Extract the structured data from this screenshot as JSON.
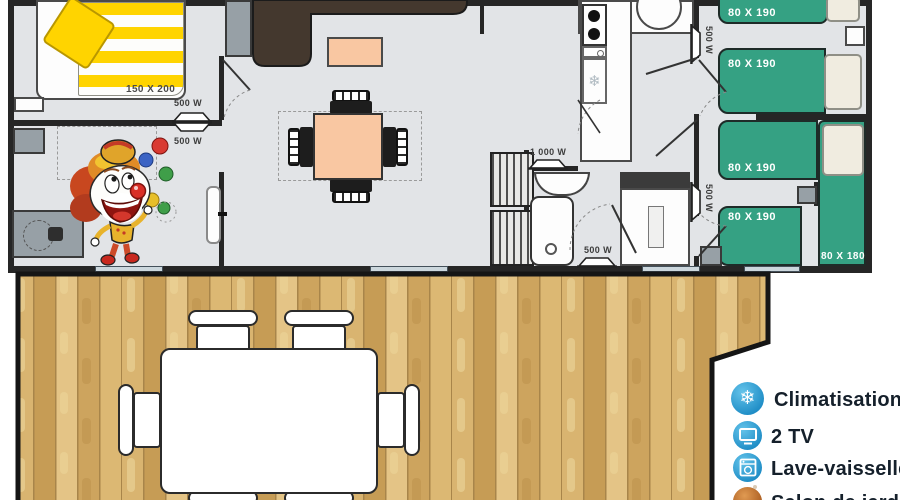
{
  "plan": {
    "master_bedroom": {
      "bed_label": "150 X 200"
    },
    "bedroom1": {
      "bed1_label": "80 X 190",
      "bed2_label": "80 X 190"
    },
    "bedroom2": {
      "bed3_label": "80 X 190",
      "bed4_label": "80 X 190",
      "corner_bed_label": "80 X 180"
    },
    "heaters": {
      "living_top": "500 W",
      "living_bottom": "500 W",
      "hall_upper": "500 W",
      "hall_lower": "500 W",
      "bathroom": "1 000 W",
      "shower_room": "500 W"
    }
  },
  "legend": {
    "items": [
      {
        "icon": "snowflake",
        "label": "Climatisation"
      },
      {
        "icon": "tv",
        "label": "2 TV"
      },
      {
        "icon": "dishwasher",
        "label": "Lave-vaisselle"
      },
      {
        "icon": "garden",
        "label": "Salon de jardin"
      }
    ]
  },
  "colors": {
    "bed_green": "#35a183",
    "accent_blue": "#2f9fd6",
    "wood_light": "#d9b470",
    "table_peach": "#f9c7a2",
    "sofa_brown": "#44382e"
  }
}
